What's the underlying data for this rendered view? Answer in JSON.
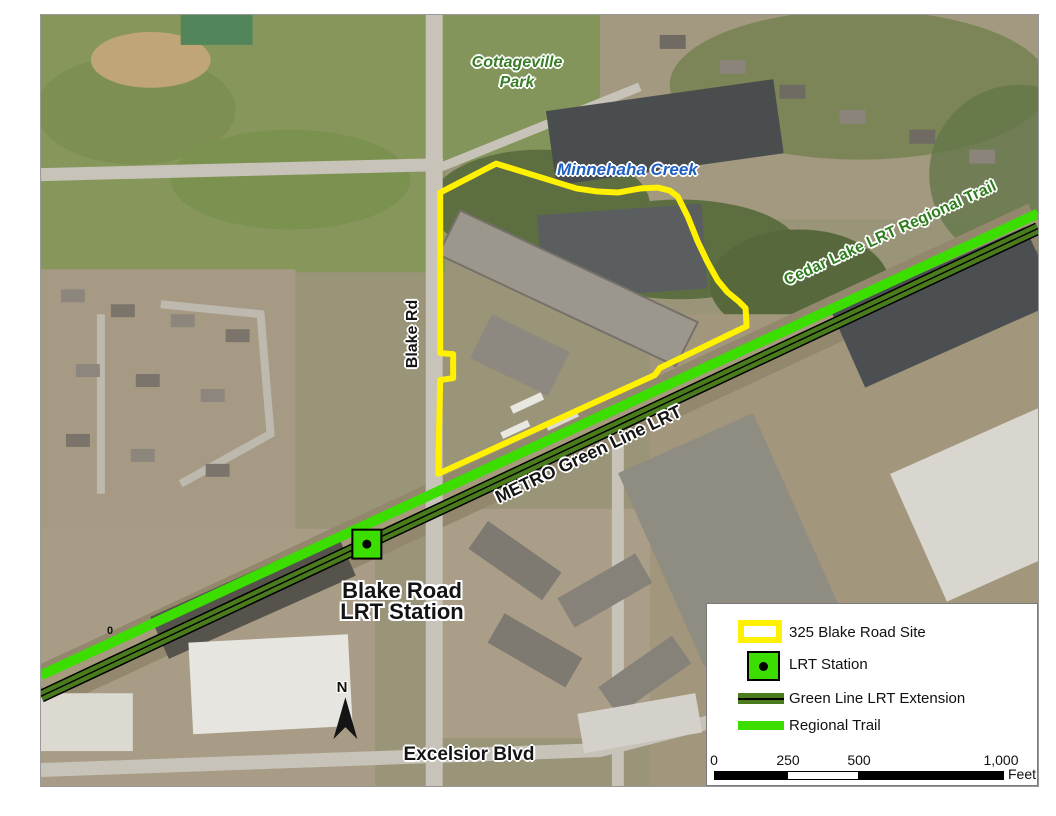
{
  "map": {
    "labels": {
      "park_line1": "Cottageville",
      "park_line2": "Park",
      "creek": "Minnehaha Creek",
      "cedar_trail": "Cedar Lake LRT Regional Trail",
      "metro_lrt": "METRO Green Line LRT",
      "blake_rd": "Blake Rd",
      "station_line1": "Blake Road",
      "station_line2": "LRT Station",
      "excelsior": "Excelsior Blvd",
      "trail_marker": "0",
      "north_arrow": "N"
    }
  },
  "legend": {
    "items": [
      {
        "label": "325 Blake Road Site"
      },
      {
        "label": "LRT Station"
      },
      {
        "label": "Green Line LRT Extension"
      },
      {
        "label": "Regional Trail"
      }
    ],
    "scale": {
      "ticks": [
        "0",
        "250",
        "500",
        "1,000"
      ],
      "unit": "Feet"
    }
  },
  "colors": {
    "site_yellow": "#FFF100",
    "trail_green": "#3CDE00",
    "lrt_green": "#4A7B1D",
    "creek_blue": "#1E5FC1",
    "park_label_green": "#3A7D28",
    "trail_label_green": "#2F7D1F",
    "label_black": "#141414",
    "legend_border": "#7A7A7A",
    "map_border": "#999999",
    "halo_white": "#FFFFFF"
  }
}
